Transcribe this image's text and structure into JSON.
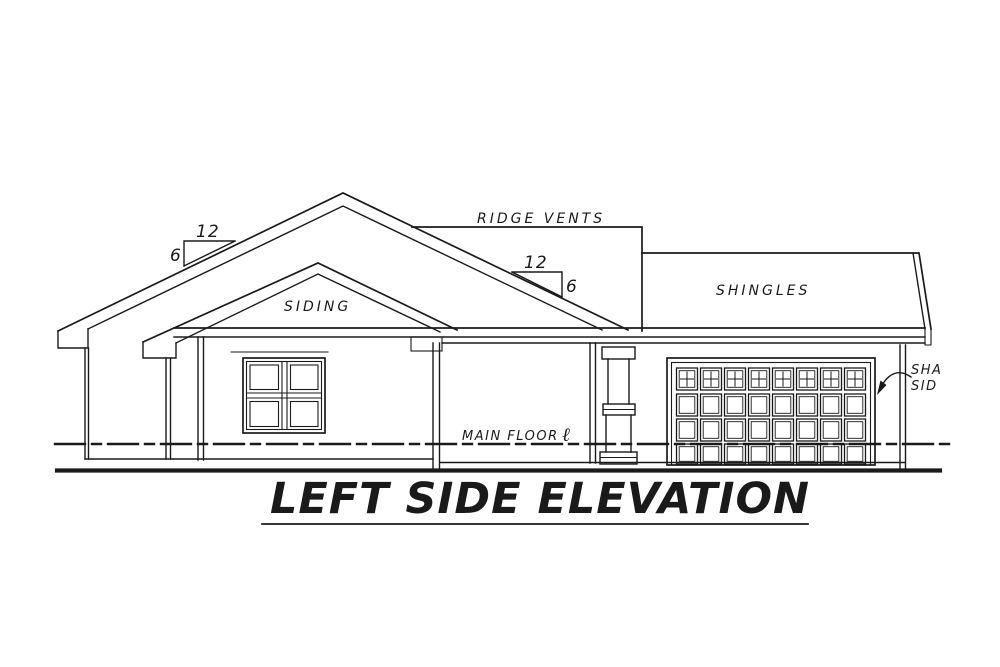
{
  "drawing": {
    "title": "LEFT SIDE ELEVATION",
    "labels": {
      "ridge_vents": "RIDGE VENTS",
      "siding": "SIDING",
      "shingles": "SHINGLES",
      "main_floor": "MAIN FLOOR",
      "main_floor_symbol": "ℓ",
      "shake_siding_line1": "SHA",
      "shake_siding_line2": "SID"
    },
    "slope_markers": {
      "left": {
        "run": "12",
        "rise": "6"
      },
      "right": {
        "run": "12",
        "rise": "6"
      }
    },
    "garage_door": {
      "panel_columns": 8,
      "panel_rows": 4,
      "top_row_style": "windows"
    },
    "window": {
      "panes_horizontal": 2,
      "panes_vertical": 2
    },
    "colors": {
      "line": "#1a1a1a",
      "background": "#ffffff"
    }
  }
}
